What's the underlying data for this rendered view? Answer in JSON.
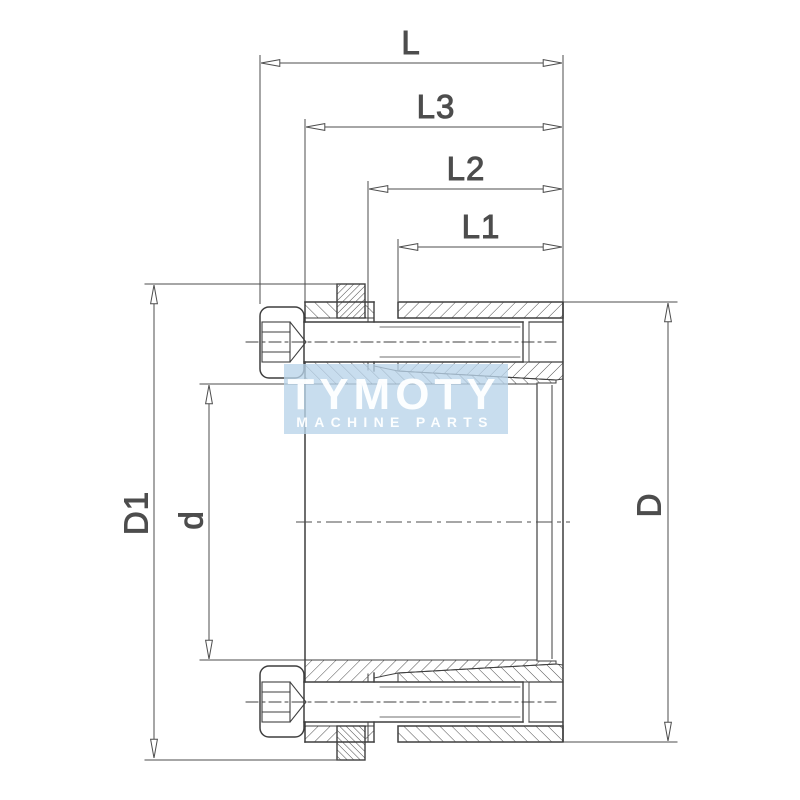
{
  "drawing": {
    "description_labels": {
      "overall_length": "L",
      "length_l3": "L3",
      "length_l2": "L2",
      "length_l1": "L1",
      "flange_diameter": "D1",
      "bore_diameter": "d",
      "outer_diameter": "D"
    },
    "line_color": "#3f3f3f",
    "dim_color": "#4d4d4d",
    "background_color": "#ffffff"
  },
  "watermark": {
    "brand": "TYMOTY",
    "tagline": "MACHINE PARTS",
    "bg_color": "#b8d4e9",
    "text_color": "#ffffff"
  }
}
